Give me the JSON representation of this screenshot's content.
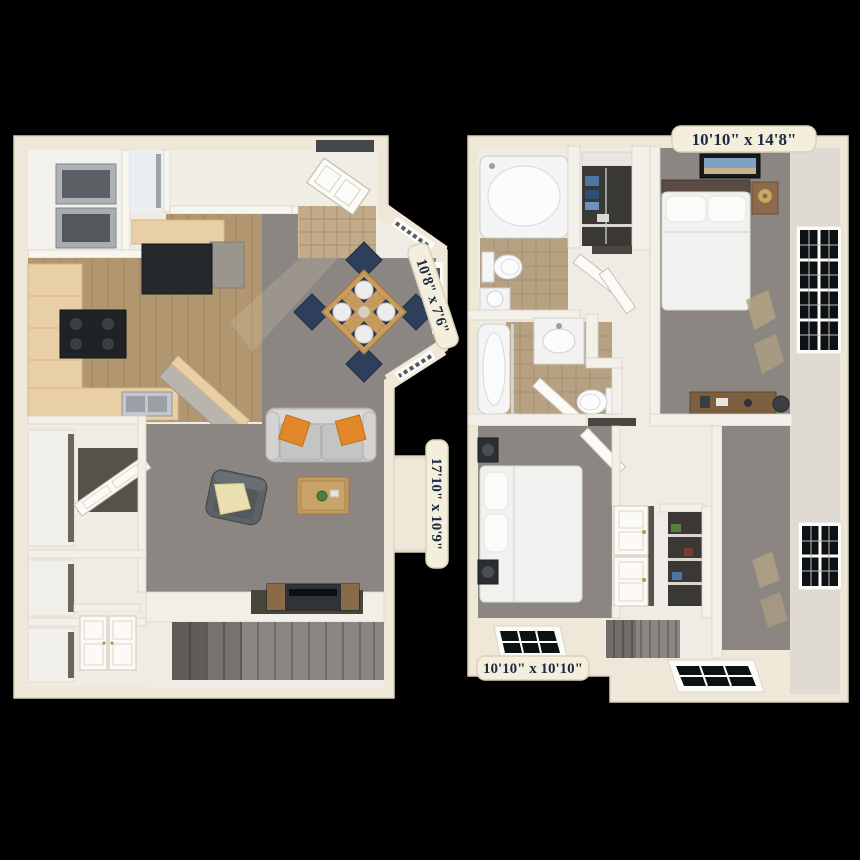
{
  "scene": {
    "description": "3D rendered two-level apartment floor plan on black background",
    "background": "#000000"
  },
  "room_labels": {
    "bedroom_1": "10'10\" x 14'8\"",
    "dining_area": "10'8\" x 7'6\"",
    "living_room": "17'10\" x 10'9\"",
    "bedroom_2": "10'10\" x 10'10\""
  },
  "palette": {
    "wall_cream": "#efe8d8",
    "wall_face": "#dfdbd2",
    "floor_white": "#efece6",
    "carpet_gray": "#8b8681",
    "wood_floor": "#b1966f",
    "tile_tan": "#c2ab88",
    "bath_tile": "#b7a183",
    "cabinet_beige": "#e9cfa5",
    "appliance_dark": "#26292c",
    "fixture_white": "#f7f8f7",
    "sofa_gray": "#c7c8c6",
    "pillow_orange": "#e2882a",
    "chair_navy": "#2d3f5a",
    "table_wood": "#c89a5e",
    "window_glass": "#0e1114",
    "label_bg": "#f4eedd",
    "label_border": "#d9d1ba",
    "label_text": "#1d2a44"
  }
}
